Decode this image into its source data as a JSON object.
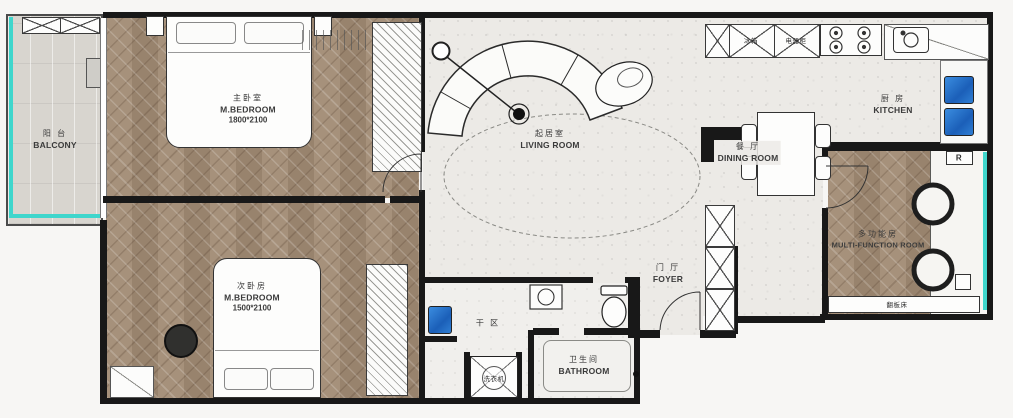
{
  "rooms": {
    "balcony": {
      "zh": "阳 台",
      "en": "BALCONY"
    },
    "master_bedroom": {
      "zh": "主卧室",
      "en": "M.BEDROOM",
      "dims": "1800*2100"
    },
    "second_bedroom": {
      "zh": "次卧房",
      "en": "M.BEDROOM",
      "dims": "1500*2100"
    },
    "living_room": {
      "zh": "起居室",
      "en": "LIVING ROOM"
    },
    "kitchen": {
      "zh": "厨 房",
      "en": "KITCHEN"
    },
    "dining_room": {
      "zh": "餐 厅",
      "en": "DINING ROOM"
    },
    "foyer": {
      "zh": "门 厅",
      "en": "FOYER"
    },
    "bathroom": {
      "zh": "卫生间",
      "en": "BATHROOM"
    },
    "multi_function_room": {
      "zh": "多功能房",
      "en": "MULTI-FUNCTION ROOM"
    },
    "dry_area": {
      "zh": "干 区",
      "en": ""
    }
  },
  "fixtures": {
    "washing_machine": "洗衣机",
    "fridge": "冰箱",
    "appliance_cabinet": "电器柜",
    "fold_down_bed": "翻板床",
    "radiator_label": "R"
  },
  "colors": {
    "wall": "#181818",
    "wood_floor": "#9f8a74",
    "balcony_floor": "#d8d5cf",
    "tile_floor": "#eceae6",
    "window_accent": "#3fd6cc",
    "sink_blue": "#2274cf"
  }
}
